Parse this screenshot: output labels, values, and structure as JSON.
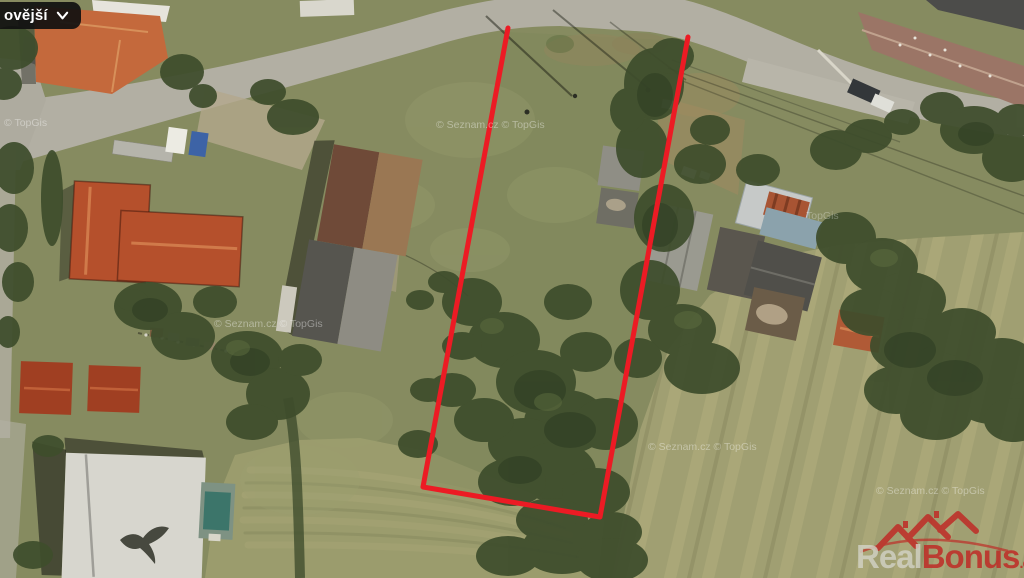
{
  "controls": {
    "version_dropdown": {
      "label": "ovější",
      "icon": "chevron-down"
    }
  },
  "watermarks": {
    "w1": "© TopGis",
    "w2": "© Seznam.cz © TopGis",
    "w3": "© Seznam.cz © TopGis",
    "w4": "TopGis",
    "w5": "© Seznam.cz © TopGis",
    "w6": "© Seznam.cz © TopGis"
  },
  "brand": {
    "name_part1": "Real",
    "name_part2": "Bonus",
    "tld": ".cz",
    "accent_color": "#bf2b26",
    "muted_color": "#d9d9d2"
  },
  "parcel": {
    "outline_color": "#ec1b24"
  },
  "palette": {
    "grass": "#868b60",
    "field": "#a09f72",
    "road": "#b2afa3",
    "tree": "#3e4d2c",
    "roof_orange": "#c4693c",
    "roof_red": "#b5502c"
  }
}
